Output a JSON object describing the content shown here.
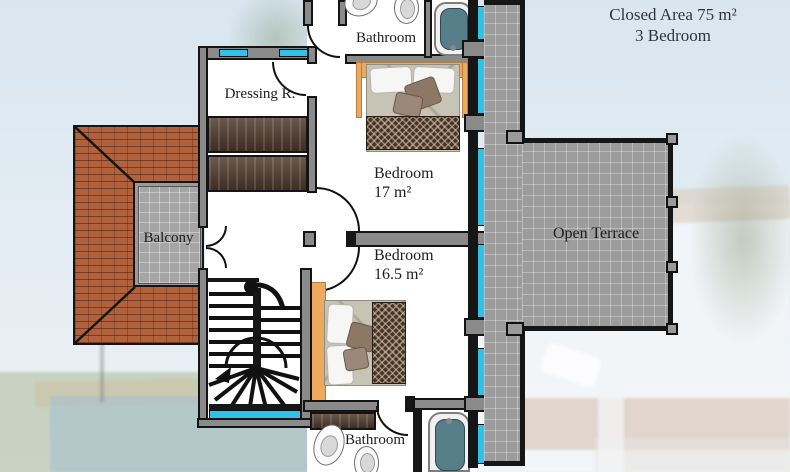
{
  "header": {
    "closed_area": "Closed Area 75 m²",
    "bedrooms": "3 Bedroom"
  },
  "rooms": {
    "bathroom_top": "Bathroom",
    "dressing": "Dressing R.",
    "bedroom_1": {
      "name": "Bedroom",
      "area": "17 m²"
    },
    "bedroom_2": {
      "name": "Bedroom",
      "area": "16.5 m²"
    },
    "balcony": "Balcony",
    "open_terrace": "Open Terrace",
    "bathroom_bottom": "Bathroom"
  },
  "plan_symbols": [
    "bathtub-icon",
    "toilet-icon",
    "sink-icon",
    "double-bed-icon",
    "wardrobe-icon",
    "staircase-icon",
    "window-marker",
    "door-swing-arc",
    "railing-post",
    "roof-tiles",
    "floor-tiles"
  ],
  "colors": {
    "window_glass": "#2ec2e8",
    "wall_fill": "#8a8a8a",
    "wall_outline": "#141414",
    "roof_tile": "#b2613d",
    "terrace_tile": "#9c9c9c",
    "tub_water": "#577f8a",
    "wardrobe_wood": "#4e392b",
    "bed_frame": "#edaa5e",
    "title_text": "#2f3540"
  }
}
